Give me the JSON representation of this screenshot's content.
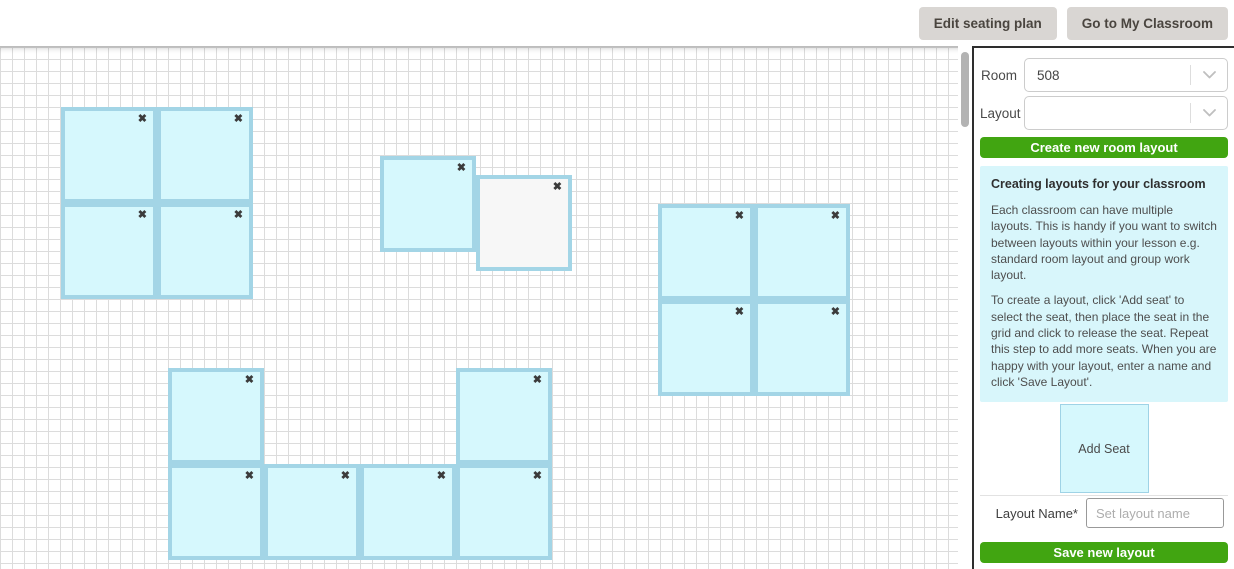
{
  "header": {
    "edit_seating_plan_label": "Edit seating plan",
    "go_to_classroom_label": "Go to My Classroom"
  },
  "sidebar": {
    "room_label": "Room",
    "room_value": "508",
    "layout_label": "Layout",
    "layout_value": "",
    "create_button_label": "Create new room layout",
    "info": {
      "title": "Creating layouts for your classroom",
      "p1": "Each classroom can have multiple layouts. This is handy if you want to switch between layouts within your lesson e.g. standard room layout and group work layout.",
      "p2": "To create a layout, click 'Add seat' to select the seat, then place the seat in the grid and click to release the seat. Repeat this step to add more seats. When you are happy with your layout, enter a name and click 'Save Layout'."
    },
    "add_seat_label": "Add Seat",
    "layout_name_label": "Layout Name*",
    "layout_name_placeholder": "Set layout name",
    "layout_name_value": "",
    "save_button_label": "Save new layout"
  },
  "canvas": {
    "close_glyph": "✖",
    "seats": [
      {
        "x": 61,
        "y": 60,
        "variant": "normal"
      },
      {
        "x": 157,
        "y": 60,
        "variant": "normal"
      },
      {
        "x": 61,
        "y": 156,
        "variant": "normal"
      },
      {
        "x": 157,
        "y": 156,
        "variant": "normal"
      },
      {
        "x": 380,
        "y": 109,
        "variant": "normal"
      },
      {
        "x": 476,
        "y": 128,
        "variant": "ghost"
      },
      {
        "x": 658,
        "y": 157,
        "variant": "normal"
      },
      {
        "x": 754,
        "y": 157,
        "variant": "normal"
      },
      {
        "x": 658,
        "y": 253,
        "variant": "normal"
      },
      {
        "x": 754,
        "y": 253,
        "variant": "normal"
      },
      {
        "x": 168,
        "y": 321,
        "variant": "normal"
      },
      {
        "x": 456,
        "y": 321,
        "variant": "normal"
      },
      {
        "x": 168,
        "y": 417,
        "variant": "normal"
      },
      {
        "x": 264,
        "y": 417,
        "variant": "normal"
      },
      {
        "x": 360,
        "y": 417,
        "variant": "normal"
      },
      {
        "x": 456,
        "y": 417,
        "variant": "normal"
      }
    ]
  },
  "colors": {
    "accent_green": "#41a511",
    "seat_fill": "#d6f8fd",
    "seat_border": "#a3d5e6",
    "info_bg": "#d8f6fb",
    "topbar_button_bg": "#d9d6d3"
  }
}
